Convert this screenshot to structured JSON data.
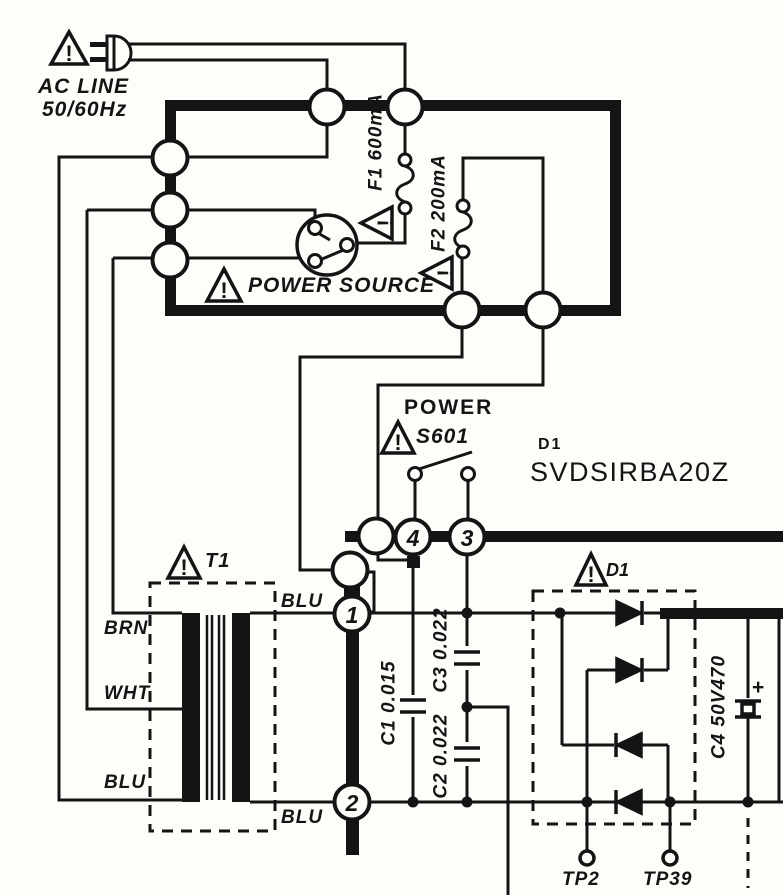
{
  "schematic": {
    "ac_line_1": "AC LINE",
    "ac_line_2": "50/60Hz",
    "fuse1_label": "F1 600mA",
    "fuse2_label": "F2 200mA",
    "power_source_label": "POWER SOURCE",
    "switch_title": "POWER",
    "switch_ref": "S601",
    "rectifier_ref": "D1",
    "rectifier_part": "SVDSIRBA20Z",
    "bridge_ref": "D1",
    "transformer_ref": "T1",
    "wire_brn": "BRN",
    "wire_wht": "WHT",
    "wire_blu_left": "BLU",
    "wire_blu_top": "BLU",
    "wire_blu_bottom": "BLU",
    "pin1": "1",
    "pin2": "2",
    "pin3": "3",
    "pin4": "4",
    "cap1_label": "C1 0.015",
    "cap2_label": "C2 0.022",
    "cap3_label": "C3 0.022",
    "cap4_label": "C4 50V470",
    "c4_plus": "+",
    "tp2_label": "TP2",
    "tp39_label": "TP39",
    "warning_mark": "!",
    "colors": {
      "ink": "#141414",
      "paper": "#fdfdfa"
    }
  }
}
